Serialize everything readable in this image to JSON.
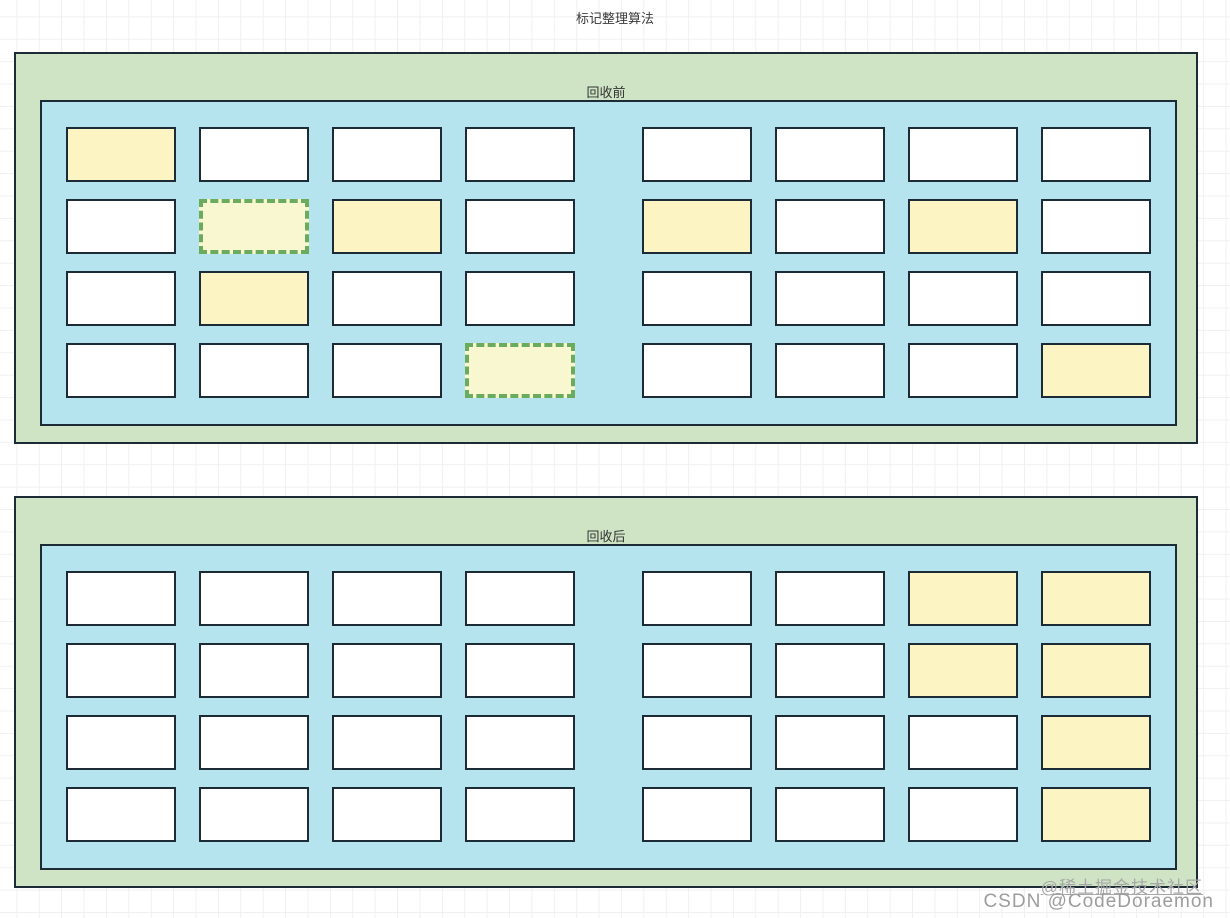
{
  "title": "标记整理算法",
  "colors": {
    "grid_line": "#f0f0f2",
    "panel_bg": "#cee4c4",
    "memory_bg": "#b5e3ee",
    "block_border": "#1c2b36",
    "free_fill": "#ffffff",
    "live_fill": "#fcf4c3",
    "garbage_fill": "#f9f7d0",
    "garbage_border": "#6aab5e"
  },
  "panels": [
    {
      "id": "before",
      "label": "回收前",
      "grid": [
        [
          "live",
          "free",
          "free",
          "free",
          "free",
          "free",
          "free",
          "free"
        ],
        [
          "free",
          "garbage",
          "live",
          "free",
          "live",
          "free",
          "live",
          "free"
        ],
        [
          "free",
          "live",
          "free",
          "free",
          "free",
          "free",
          "free",
          "free"
        ],
        [
          "free",
          "free",
          "free",
          "garbage",
          "free",
          "free",
          "free",
          "live"
        ]
      ]
    },
    {
      "id": "after",
      "label": "回收后",
      "grid": [
        [
          "free",
          "free",
          "free",
          "free",
          "free",
          "free",
          "live",
          "live"
        ],
        [
          "free",
          "free",
          "free",
          "free",
          "free",
          "free",
          "live",
          "live"
        ],
        [
          "free",
          "free",
          "free",
          "free",
          "free",
          "free",
          "free",
          "live"
        ],
        [
          "free",
          "free",
          "free",
          "free",
          "free",
          "free",
          "free",
          "live"
        ]
      ]
    }
  ],
  "watermarks": {
    "juejin": "@稀土掘金技术社区",
    "csdn": "CSDN @CodeDoraemon"
  }
}
